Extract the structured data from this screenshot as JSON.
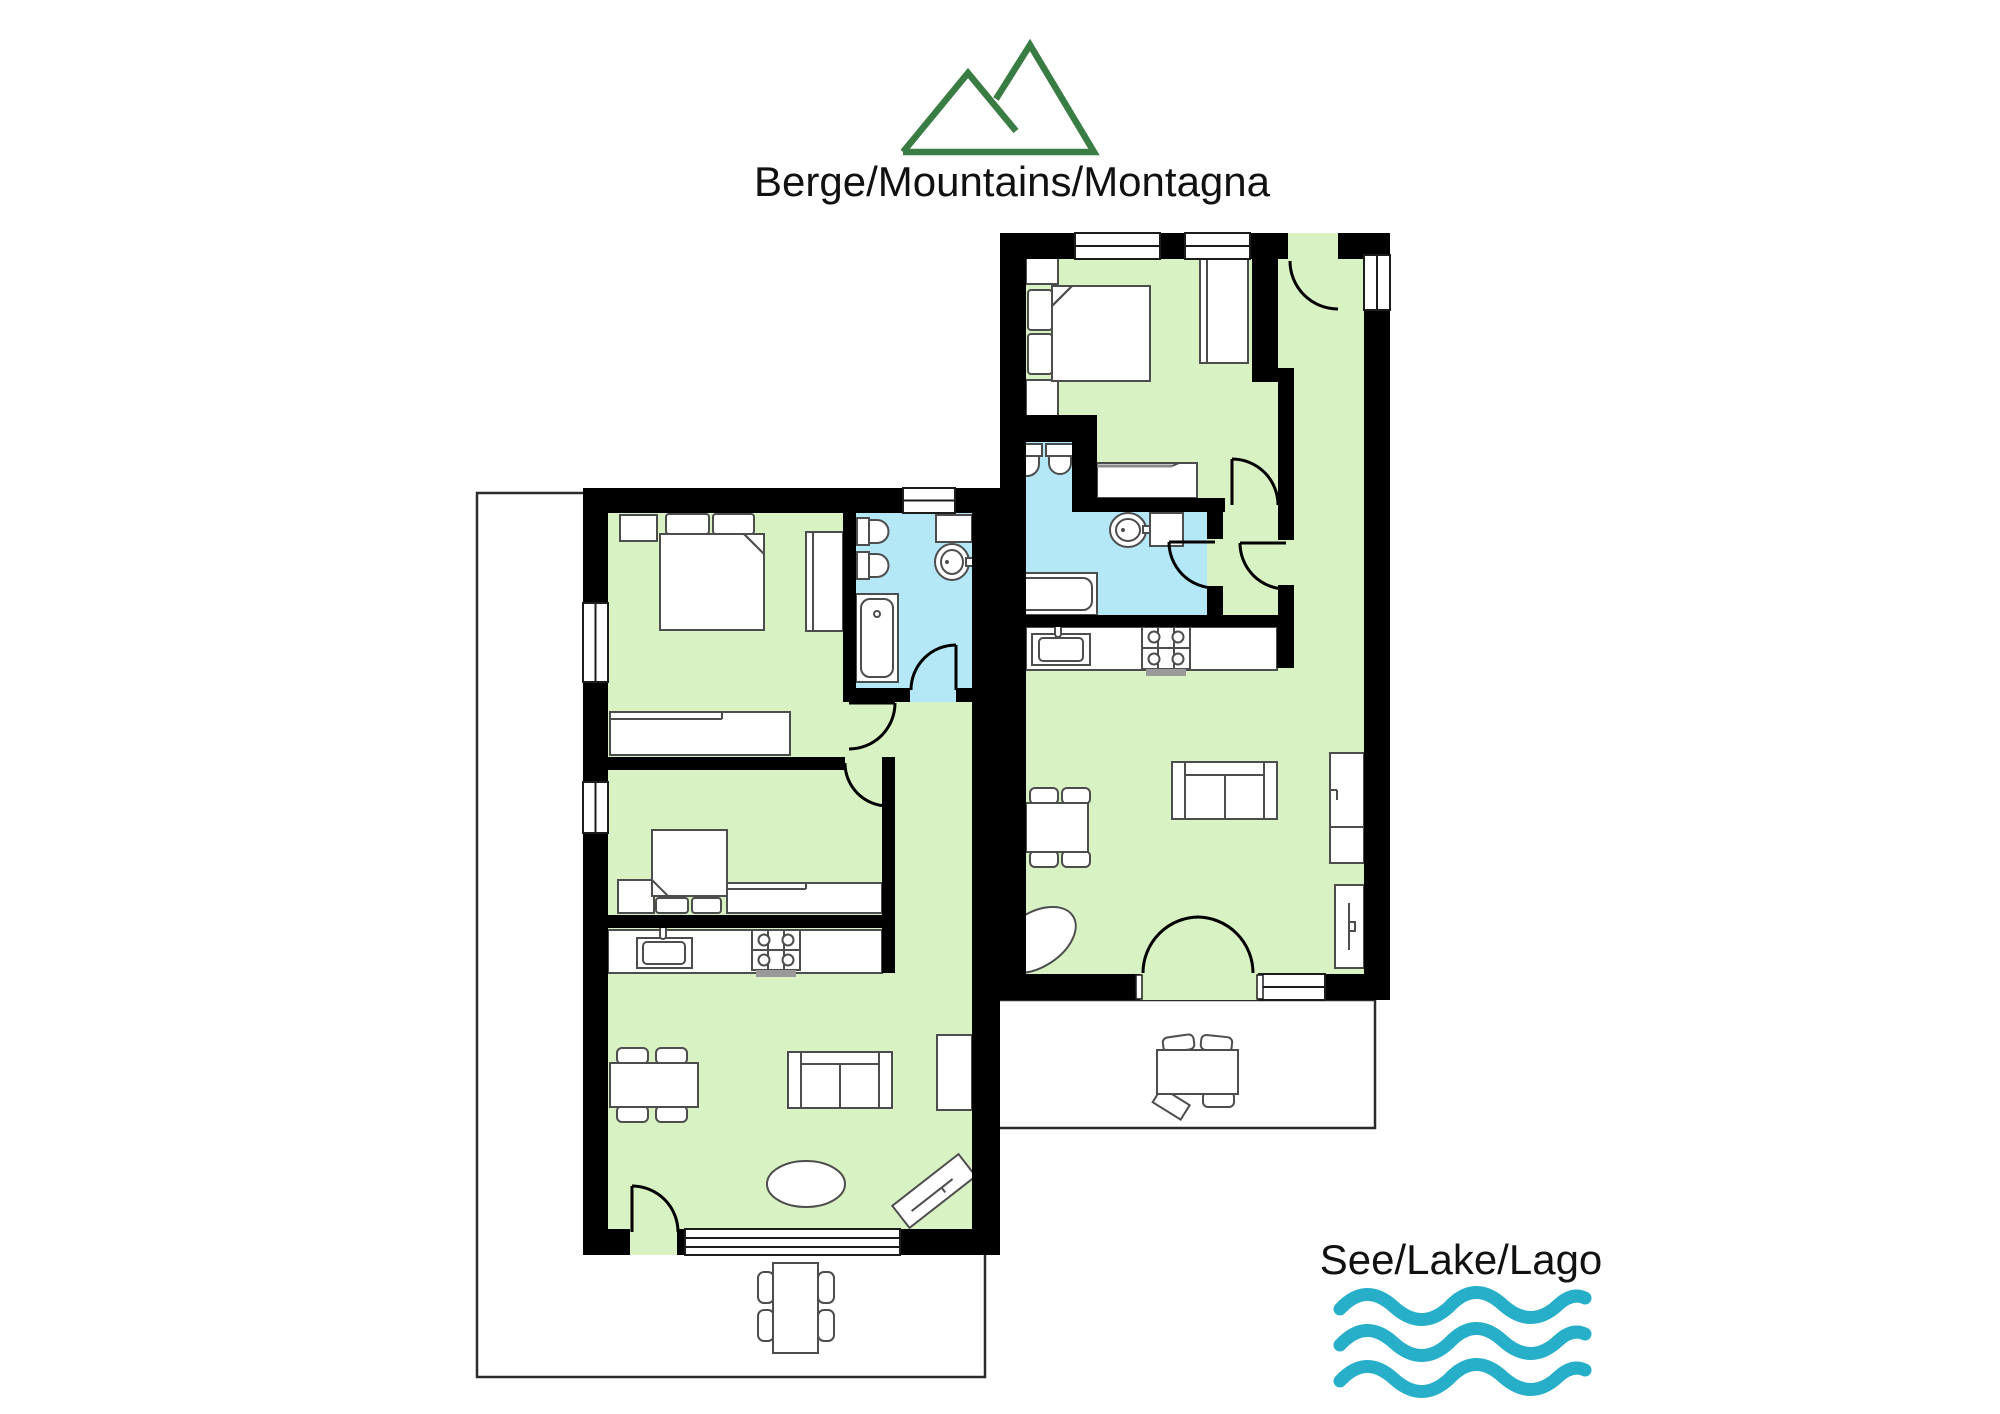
{
  "header": {
    "mountains_label": "Berge/Mountains/Montagna"
  },
  "footer": {
    "lake_label": "See/Lake/Lago"
  },
  "icons": {
    "mountain": "mountain-icon (two overlapping peaks, green outline)",
    "waves": "waves-icon (three horizontal wavy lines, teal)"
  },
  "colors": {
    "floor_green": "#d8f2c3",
    "bath_blue": "#b4e8f7",
    "wall_black": "#000000",
    "mountain_green": "#3a7d44",
    "lake_teal": "#27afc9",
    "furniture_stroke": "#4d4d4d",
    "terrace_outline": "#2b2b2b",
    "counter_edge": "#8a8a8a",
    "stove_gray": "#9a9a9a",
    "text_color": "#111111"
  }
}
